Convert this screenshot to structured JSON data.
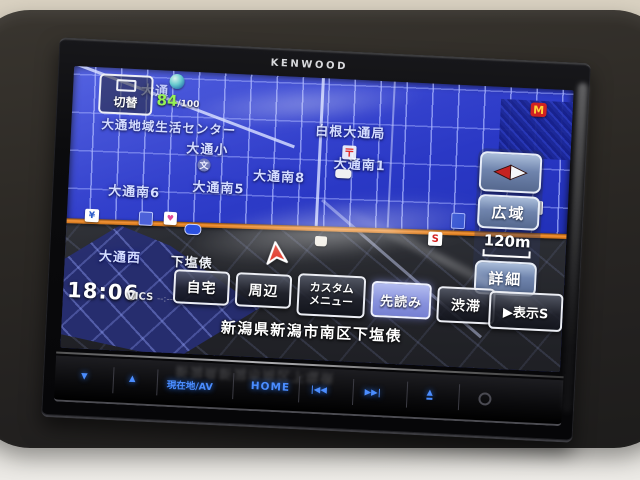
{
  "device": {
    "brand": "KENWOOD",
    "buttons": {
      "vol_down": "▾",
      "vol_up": "▴",
      "current_av": "現在地/AV",
      "home": "HOME",
      "prev": "|◀◀",
      "next": "▶▶|",
      "eject": "▲"
    }
  },
  "screen": {
    "status": {
      "switch_label": "切替",
      "gps_value": "84",
      "gps_max": "/100",
      "clock": "18:06",
      "vics": "VICS",
      "vics_time": "--:--"
    },
    "map": {
      "labels": {
        "odori_top": "大通",
        "center_name": "大通地域生活センター",
        "post_office": "白根大通局",
        "school": "大通小",
        "minami6": "大通南6",
        "minami5": "大通南5",
        "minami8": "大通南8",
        "minami1": "大通南1",
        "nishi": "大通西",
        "shimoshiodawara": "下塩俵"
      },
      "marks": {
        "postal": "〒",
        "school": "文",
        "mcdonalds": "M",
        "seven": "7",
        "suzuki": "S",
        "bank": "¥",
        "food": "♥"
      }
    },
    "right_controls": {
      "wide": "広域",
      "scale": "120m",
      "detail": "詳細"
    },
    "menu": {
      "home": "自宅",
      "nearby": "周辺",
      "custom_line1": "カスタム",
      "custom_line2": "メニュー",
      "lookahead": "先読み",
      "traffic": "渋滞",
      "display": "▶表示S"
    },
    "address": "新潟県新潟市南区下塩俵"
  }
}
